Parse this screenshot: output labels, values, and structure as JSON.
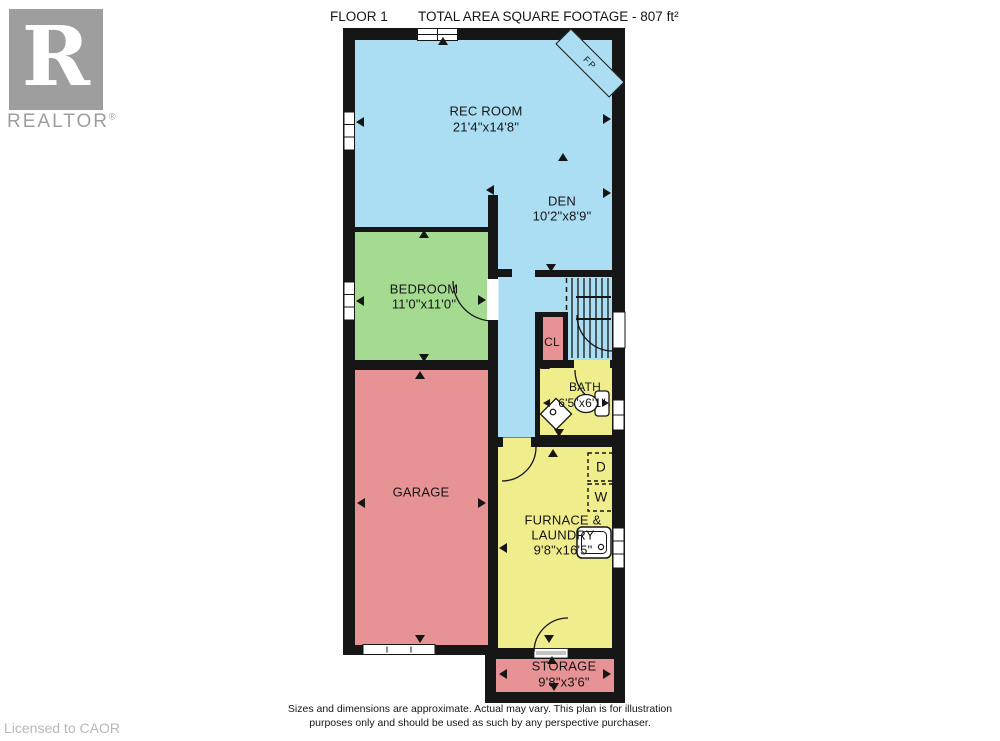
{
  "header": {
    "floor_label": "FLOOR 1",
    "area_label": "TOTAL AREA SQUARE FOOTAGE - 807 ft²"
  },
  "branding": {
    "logo_letter": "R",
    "logo_text": "REALTOR",
    "registered_mark": "®",
    "license_text": "Licensed to CAOR"
  },
  "rooms": {
    "rec_room": {
      "name": "REC ROOM",
      "dims": "21'4\"x14'8\""
    },
    "den": {
      "name": "DEN",
      "dims": "10'2\"x8'9\""
    },
    "bedroom": {
      "name": "BEDROOM",
      "dims": "11'0\"x11'0\""
    },
    "garage": {
      "name": "GARAGE"
    },
    "closet": {
      "name": "CL"
    },
    "bath": {
      "name": "BATH",
      "dims": "6'5\"x6'1\""
    },
    "furnace_laundry": {
      "name_line1": "FURNACE &",
      "name_line2": "LAUNDRY",
      "dims": "9'8\"x16'5\""
    },
    "storage": {
      "name": "STORAGE",
      "dims": "9'8\"x3'6\""
    }
  },
  "appliances": {
    "dryer": "D",
    "washer": "W",
    "fireplace": "FP"
  },
  "footer": {
    "disclaimer_line1": "Sizes and dimensions are approximate. Actual may vary. This plan is for illustration",
    "disclaimer_line2": "purposes only and should be used as such by any perspective purchaser."
  },
  "icons": [
    "fireplace-icon",
    "stairs-icon",
    "window-icon",
    "door-arc-icon",
    "toilet-icon",
    "sink-icon",
    "laundry-tub-icon",
    "washer-box-icon",
    "dryer-box-icon",
    "garage-door-icon",
    "dimension-arrow-icon",
    "realtor-logo"
  ],
  "colors": {
    "living_blue": "#ABDEF2",
    "bedroom_green": "#A4DB91",
    "garage_pink": "#E79295",
    "bath_yellow": "#F0EE8C",
    "wall_black": "#161616",
    "logo_gray": "#9E9E9E",
    "license_gray": "#B9B9B9"
  }
}
